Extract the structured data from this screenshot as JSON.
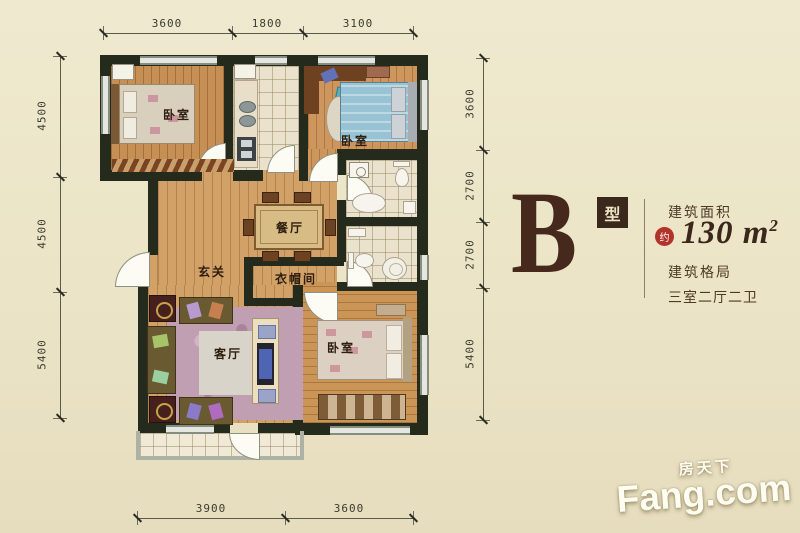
{
  "panel": {
    "type_letter": "B",
    "type_suffix": "型",
    "area_label": "建筑面积",
    "area_approx": "约",
    "area_value": "130",
    "area_unit": " m",
    "area_exp": "2",
    "layout_label": "建筑格局",
    "layout_value": "三室二厅二卫"
  },
  "rooms": {
    "bedroom1": "卧室",
    "bedroom2": "卧室",
    "bedroom3": "卧室",
    "dining": "餐厅",
    "entry": "玄关",
    "cloakroom": "衣帽间",
    "living": "客厅"
  },
  "dimensions": {
    "top": [
      "3600",
      "1800",
      "3100"
    ],
    "left": [
      "4500",
      "4500",
      "5400"
    ],
    "right": [
      "3600",
      "2700",
      "2700",
      "5400"
    ],
    "bottom": [
      "3900",
      "3600"
    ]
  },
  "watermark": {
    "cn": "房天下",
    "en": "Fang.com"
  },
  "colors": {
    "background": "#ebe4c6",
    "wall": "#242a1c",
    "wood_floor": "#cf9c61",
    "tile_floor": "#ebe2cd",
    "accent_red": "#b2332a",
    "panel_brown": "#46291c"
  }
}
